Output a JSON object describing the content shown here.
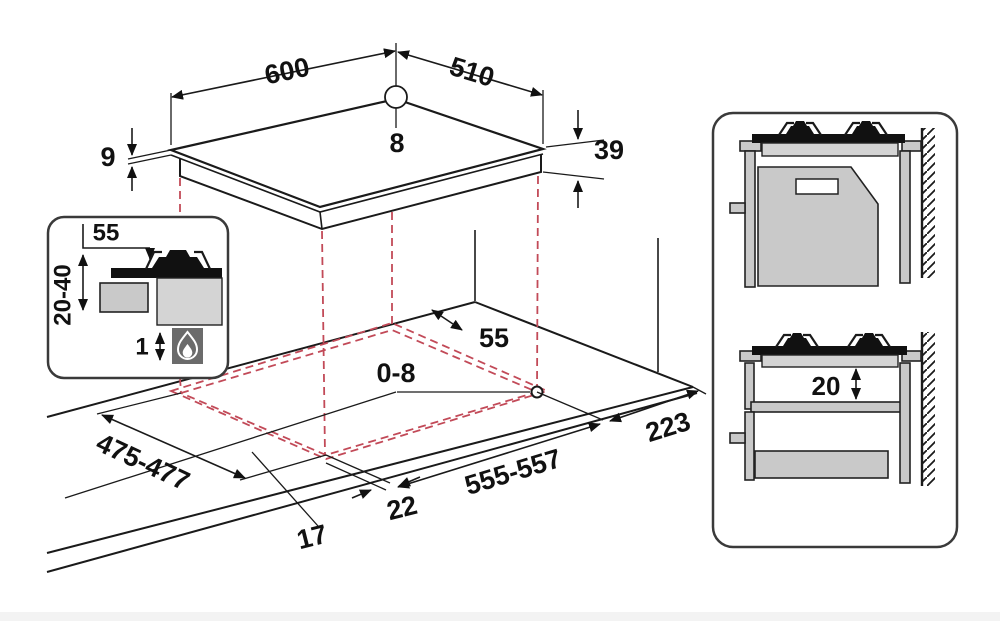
{
  "title": "Gas hob installation dimensions diagram",
  "colors": {
    "line": "#1a1a1a",
    "cutout_dash": "#c24a58",
    "cabinet_gray": "#c9c9c9",
    "hob_band_gray": "#d4d4d4",
    "flame_box_gray": "#6b6b6b",
    "background": "#ffffff"
  },
  "hob": {
    "width": "600",
    "depth": "510",
    "hole_diameter": "8",
    "glass_thickness": "9",
    "body_height": "39"
  },
  "inset_detail": {
    "side_clearance": "55",
    "under_clearance_range": "20-40",
    "min_gap": "1",
    "icon": "flame-icon"
  },
  "cutout": {
    "rear_clearance": "55",
    "corner_radius": "0-8",
    "depth": "475-477",
    "front_overhang": "17",
    "side_overhang": "22",
    "width": "555-557",
    "right_clearance": "223"
  },
  "side_views": {
    "upper": "oven installed under hob against wall",
    "lower": "shelf and drawer under hob against wall",
    "shelf_gap": "20",
    "icons": [
      "burner-icon",
      "wall-hatch-icon",
      "oven-vent-icon",
      "drawer-icon"
    ]
  }
}
